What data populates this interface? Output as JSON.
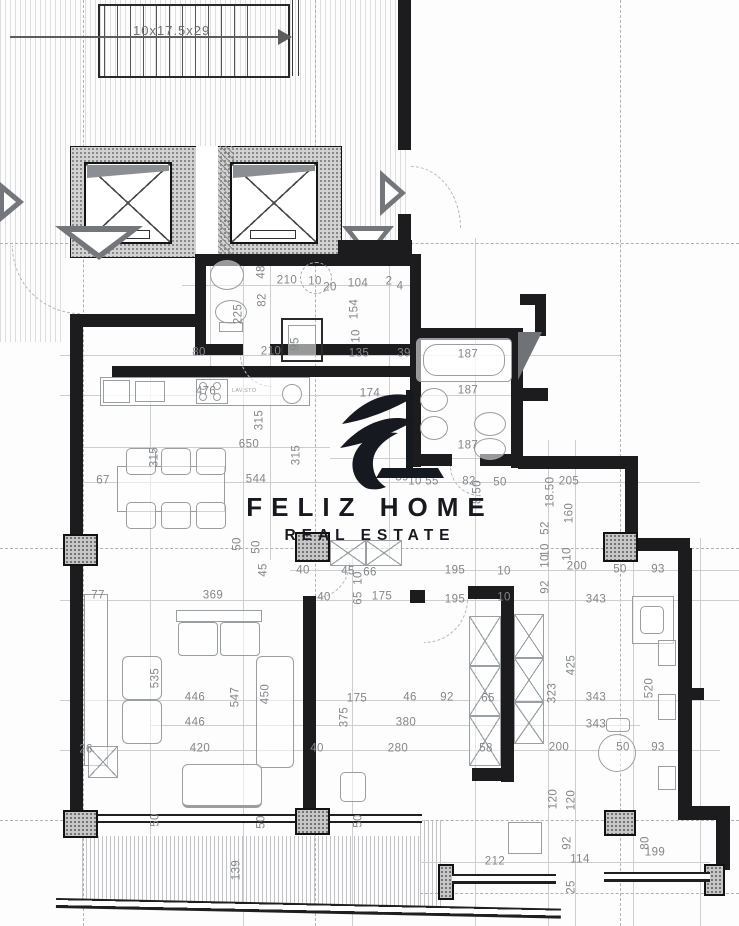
{
  "logo": {
    "title": "FELIZ HOME",
    "subtitle": "REAL ESTATE"
  },
  "stairs": {
    "label": "10x17.5x29"
  },
  "kitchen": {
    "appliance_label": "LAV.STO"
  },
  "colors": {
    "wall": "#1c1c1e",
    "dim_text": "#84868a",
    "logo": "#17191f",
    "hatch": "#5f646c"
  },
  "dimensions": [
    {
      "text": "48",
      "x": 262,
      "y": 272,
      "rotated": true
    },
    {
      "text": "210",
      "x": 287,
      "y": 281
    },
    {
      "text": "10",
      "x": 315,
      "y": 282
    },
    {
      "text": "20",
      "x": 330,
      "y": 288
    },
    {
      "text": "104",
      "x": 358,
      "y": 284
    },
    {
      "text": "2",
      "x": 389,
      "y": 282
    },
    {
      "text": "4",
      "x": 400,
      "y": 287
    },
    {
      "text": "82",
      "x": 263,
      "y": 300,
      "rotated": true
    },
    {
      "text": "225",
      "x": 239,
      "y": 314,
      "rotated": true
    },
    {
      "text": "154",
      "x": 355,
      "y": 309,
      "rotated": true
    },
    {
      "text": "10",
      "x": 357,
      "y": 336,
      "rotated": true
    },
    {
      "text": "95",
      "x": 296,
      "y": 344,
      "rotated": true
    },
    {
      "text": "80",
      "x": 199,
      "y": 353
    },
    {
      "text": "210",
      "x": 271,
      "y": 352
    },
    {
      "text": "135",
      "x": 359,
      "y": 354
    },
    {
      "text": "39",
      "x": 404,
      "y": 354
    },
    {
      "text": "174",
      "x": 370,
      "y": 394
    },
    {
      "text": "476",
      "x": 206,
      "y": 392
    },
    {
      "text": "187",
      "x": 468,
      "y": 355
    },
    {
      "text": "187",
      "x": 468,
      "y": 391
    },
    {
      "text": "187",
      "x": 468,
      "y": 446
    },
    {
      "text": "39",
      "x": 402,
      "y": 478
    },
    {
      "text": "10",
      "x": 415,
      "y": 482
    },
    {
      "text": "55",
      "x": 432,
      "y": 482
    },
    {
      "text": "82",
      "x": 469,
      "y": 482
    },
    {
      "text": "50",
      "x": 500,
      "y": 483
    },
    {
      "text": "8.50",
      "x": 478,
      "y": 492,
      "rotated": true
    },
    {
      "text": "205",
      "x": 569,
      "y": 482
    },
    {
      "text": "18.50",
      "x": 551,
      "y": 492,
      "rotated": true
    },
    {
      "text": "160",
      "x": 570,
      "y": 513,
      "rotated": true
    },
    {
      "text": "52",
      "x": 546,
      "y": 528,
      "rotated": true
    },
    {
      "text": "10",
      "x": 546,
      "y": 550,
      "rotated": true
    },
    {
      "text": "10",
      "x": 546,
      "y": 561,
      "rotated": true
    },
    {
      "text": "92",
      "x": 546,
      "y": 587,
      "rotated": true
    },
    {
      "text": "10",
      "x": 568,
      "y": 554,
      "rotated": true
    },
    {
      "text": "200",
      "x": 577,
      "y": 567
    },
    {
      "text": "50",
      "x": 620,
      "y": 570
    },
    {
      "text": "93",
      "x": 658,
      "y": 570
    },
    {
      "text": "343",
      "x": 596,
      "y": 600
    },
    {
      "text": "315",
      "x": 260,
      "y": 420,
      "rotated": true
    },
    {
      "text": "650",
      "x": 249,
      "y": 445
    },
    {
      "text": "315",
      "x": 155,
      "y": 457,
      "rotated": true
    },
    {
      "text": "315",
      "x": 297,
      "y": 455,
      "rotated": true
    },
    {
      "text": "544",
      "x": 256,
      "y": 480
    },
    {
      "text": "67",
      "x": 103,
      "y": 481
    },
    {
      "text": "50",
      "x": 238,
      "y": 544,
      "rotated": true
    },
    {
      "text": "50",
      "x": 257,
      "y": 547,
      "rotated": true
    },
    {
      "text": "45",
      "x": 264,
      "y": 570,
      "rotated": true
    },
    {
      "text": "77",
      "x": 98,
      "y": 596
    },
    {
      "text": "369",
      "x": 213,
      "y": 596
    },
    {
      "text": "40",
      "x": 303,
      "y": 571
    },
    {
      "text": "45",
      "x": 348,
      "y": 572
    },
    {
      "text": "66",
      "x": 370,
      "y": 573
    },
    {
      "text": "10",
      "x": 359,
      "y": 578,
      "rotated": true
    },
    {
      "text": "65",
      "x": 359,
      "y": 598,
      "rotated": true
    },
    {
      "text": "175",
      "x": 382,
      "y": 597
    },
    {
      "text": "195",
      "x": 455,
      "y": 571
    },
    {
      "text": "10",
      "x": 504,
      "y": 572
    },
    {
      "text": "195",
      "x": 455,
      "y": 600
    },
    {
      "text": "10",
      "x": 504,
      "y": 598
    },
    {
      "text": "40",
      "x": 324,
      "y": 598
    },
    {
      "text": "535",
      "x": 156,
      "y": 678,
      "rotated": true
    },
    {
      "text": "446",
      "x": 195,
      "y": 698
    },
    {
      "text": "547",
      "x": 236,
      "y": 697,
      "rotated": true
    },
    {
      "text": "450",
      "x": 266,
      "y": 694,
      "rotated": true
    },
    {
      "text": "446",
      "x": 195,
      "y": 723
    },
    {
      "text": "420",
      "x": 200,
      "y": 749
    },
    {
      "text": "26",
      "x": 86,
      "y": 750
    },
    {
      "text": "40",
      "x": 317,
      "y": 749
    },
    {
      "text": "46",
      "x": 410,
      "y": 698
    },
    {
      "text": "92",
      "x": 447,
      "y": 698
    },
    {
      "text": "65",
      "x": 488,
      "y": 699
    },
    {
      "text": "175",
      "x": 357,
      "y": 699
    },
    {
      "text": "375",
      "x": 345,
      "y": 717,
      "rotated": true
    },
    {
      "text": "380",
      "x": 406,
      "y": 723
    },
    {
      "text": "280",
      "x": 398,
      "y": 749
    },
    {
      "text": "58",
      "x": 486,
      "y": 749
    },
    {
      "text": "425",
      "x": 572,
      "y": 665,
      "rotated": true
    },
    {
      "text": "323",
      "x": 553,
      "y": 693,
      "rotated": true
    },
    {
      "text": "520",
      "x": 650,
      "y": 688,
      "rotated": true
    },
    {
      "text": "343",
      "x": 596,
      "y": 698
    },
    {
      "text": "343",
      "x": 596,
      "y": 725
    },
    {
      "text": "200",
      "x": 559,
      "y": 748
    },
    {
      "text": "50",
      "x": 623,
      "y": 748
    },
    {
      "text": "93",
      "x": 658,
      "y": 748
    },
    {
      "text": "120",
      "x": 554,
      "y": 799,
      "rotated": true
    },
    {
      "text": "120",
      "x": 572,
      "y": 800,
      "rotated": true
    },
    {
      "text": "50",
      "x": 156,
      "y": 820,
      "rotated": true
    },
    {
      "text": "50",
      "x": 262,
      "y": 822,
      "rotated": true
    },
    {
      "text": "50",
      "x": 359,
      "y": 821,
      "rotated": true
    },
    {
      "text": "139",
      "x": 237,
      "y": 870,
      "rotated": true
    },
    {
      "text": "212",
      "x": 495,
      "y": 862
    },
    {
      "text": "92",
      "x": 568,
      "y": 843,
      "rotated": true
    },
    {
      "text": "114",
      "x": 580,
      "y": 860
    },
    {
      "text": "25",
      "x": 572,
      "y": 887,
      "rotated": true
    },
    {
      "text": "80",
      "x": 646,
      "y": 843,
      "rotated": true
    },
    {
      "text": "199",
      "x": 655,
      "y": 853
    }
  ]
}
